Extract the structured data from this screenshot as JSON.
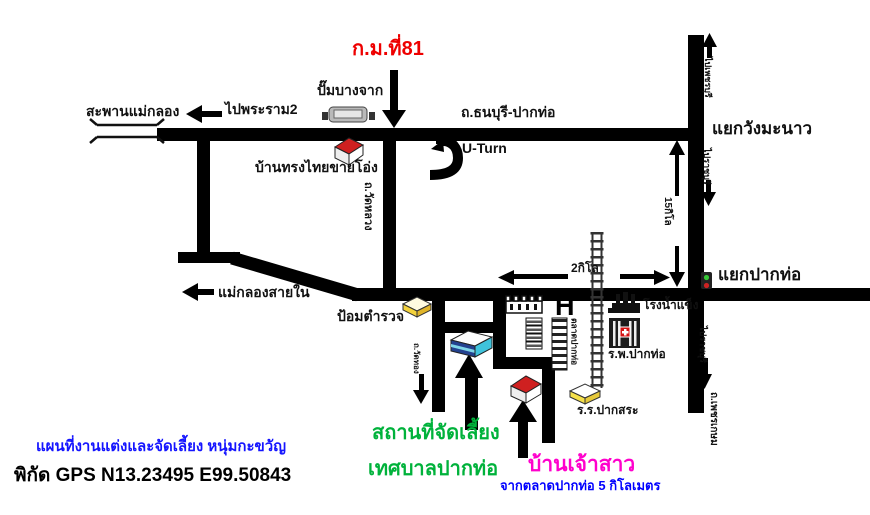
{
  "map": {
    "labels": {
      "bridge": "สะพานแม่กลอง",
      "to_rama2": "ไปพระราม2",
      "gas_station": "ปั๊มบางจาก",
      "km81": "ก.ม.ที่81",
      "thonburi_paktho_road": "ถ.ธนบุรี-ปากท่อ",
      "u_turn": "U-Turn",
      "thai_house": "บ้านทรงไทยขายโอ่ง",
      "wang_manao_junction": "แยกวังมะนาว",
      "to_phetchaburi": "ไปเพชรบุรี",
      "to_ratchaburi_upper": "ไปราชบุรี",
      "dist_15km": "15กิโล",
      "maeklong_inner": "แม่กลองสายใน",
      "police_box": "ป้อมตำรวจ",
      "wat_luang_road": "ถ.วัดหลวง",
      "wat_thong_road": "ถ.วัดทอง",
      "dist_2km": "2กิโล",
      "pak_tho_junction": "แยกปากท่อ",
      "ice_factory": "โรงน้ำแข็ง",
      "hospital_h": "H",
      "pak_tho_hospital": "ร.พ.ปากท่อ",
      "pak_tho_market": "ตลาดปากท่อ",
      "pak_sa_school": "ร.ร.ปากสระ",
      "to_ratchaburi_lower": "ไปราชบุรี",
      "phetkasem_road": "ถ.เพชรเกษม",
      "venue_line1": "สถานที่จัดเลี้ยง",
      "venue_line2": "เทศบาลปากท่อ",
      "bride_house": "บ้านเจ้าสาว",
      "from_market_note": "จากตลาดปากท่อ 5 กิโลเมตร",
      "map_title": "แผนที่งานแต่งและจัดเลี้ยง หนุ่มกะขวัญ",
      "gps": "พิกัด GPS N13.23495 E99.50843"
    },
    "colors": {
      "road": "#000000",
      "km81_red": "#ee0000",
      "venue_green": "#00b23b",
      "bride_magenta": "#ff00cc",
      "note_blue": "#0000ff",
      "title_blue": "#1414ff"
    },
    "icons": {
      "bridge": "bridge-rails",
      "gas_station": "fuel-canopy-with-pumps",
      "thai_house": "red-roof-house",
      "bride_house": "red-roof-house",
      "police_box": "yellow-slab-building",
      "school": "yellow-slab-building",
      "municipality": "blue-white-3d-building",
      "wall": "castellated-wall",
      "shophouses": "stacked-row-buildings",
      "market": "striped-stall-column",
      "railway": "ladder-track",
      "hospital": "dark-building-red-cross",
      "ice_factory": "factory-chimneys",
      "traffic_light": "green-red-signal",
      "arrows": "direction-arrows"
    }
  }
}
